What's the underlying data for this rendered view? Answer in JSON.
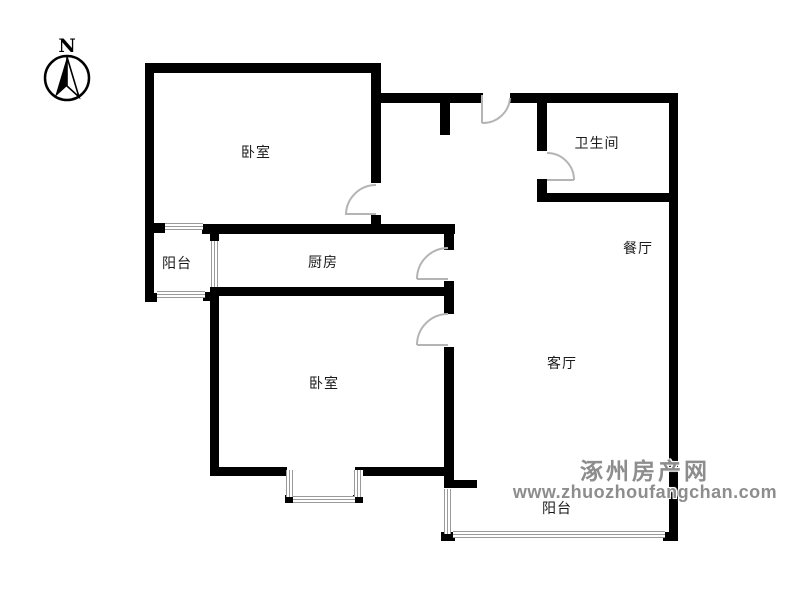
{
  "compass": {
    "north_label": "N"
  },
  "rooms": {
    "bedroom_top": "卧室",
    "bathroom": "卫生间",
    "balcony_left": "阳台",
    "kitchen": "厨房",
    "dining": "餐厅",
    "living": "客厅",
    "bedroom_bottom": "卧室",
    "balcony_bottom": "阳台"
  },
  "watermark": {
    "site_name": "涿州房产网",
    "site_url": "www.zhuozhoufangchan.com"
  },
  "colors": {
    "wall": "#000000",
    "door": "#b4b4b4",
    "window": "#9a9a9a",
    "watermark": "#8d8d8d",
    "label": "#1a1a1a"
  }
}
